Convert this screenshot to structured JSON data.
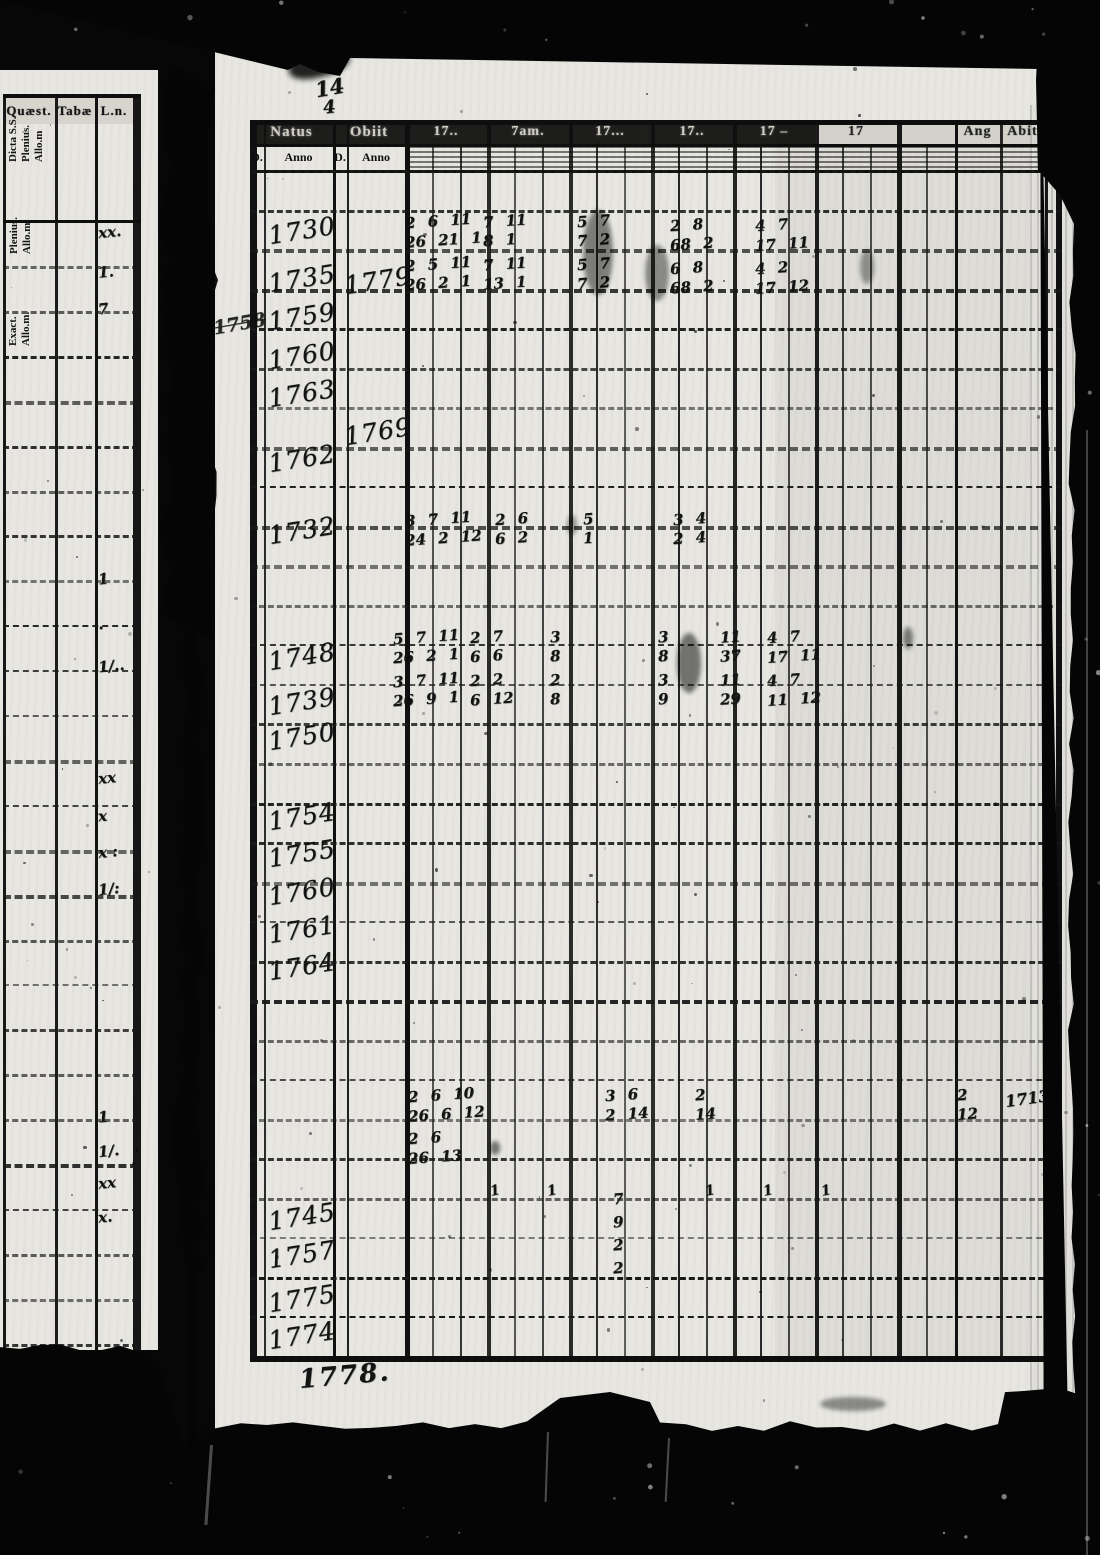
{
  "left_page": {
    "columns": [
      {
        "header": "Quæst.",
        "subheader_lines": [
          "Dicta S.S.",
          "Plenius.",
          "Allo.m"
        ]
      },
      {
        "header": "Tabæ",
        "subheader_lines": [
          "Plenius.",
          "Allo.m."
        ]
      },
      {
        "header": "L.n.",
        "subheader_lines": [
          "Exact.",
          "Allo.m."
        ]
      }
    ],
    "marks": [
      {
        "y": 233,
        "text": "xx."
      },
      {
        "y": 273,
        "text": "1."
      },
      {
        "y": 310,
        "text": "7"
      },
      {
        "y": 580,
        "text": "1"
      },
      {
        "y": 625,
        "text": "."
      },
      {
        "y": 667,
        "text": "1/.."
      },
      {
        "y": 779,
        "text": "xx"
      },
      {
        "y": 817,
        "text": "x"
      },
      {
        "y": 853,
        "text": "x :"
      },
      {
        "y": 890,
        "text": "1/:"
      },
      {
        "y": 1118,
        "text": "1"
      },
      {
        "y": 1152,
        "text": "1/."
      },
      {
        "y": 1184,
        "text": "xx"
      },
      {
        "y": 1218,
        "text": "x."
      }
    ]
  },
  "main_page": {
    "top_annotation": {
      "line1": "14",
      "line2": "4"
    },
    "margin_note": "1758",
    "footer_note": "1778.",
    "side_note": "1713",
    "table": {
      "group_headers": [
        "Natus",
        "Obiit",
        "17..",
        "7am.",
        "17...",
        "17..",
        "17 –",
        "17",
        "",
        "Ang",
        "Abit",
        ""
      ],
      "sub_headers": [
        "D.",
        "Anno",
        "D.",
        "Anno"
      ],
      "years_natus": [
        {
          "text": "1730",
          "y": 187
        },
        {
          "text": "1735",
          "y": 235
        },
        {
          "text": "1759",
          "y": 273
        },
        {
          "text": "1760",
          "y": 312
        },
        {
          "text": "1763",
          "y": 350
        },
        {
          "text": "1762",
          "y": 415
        },
        {
          "text": "1732",
          "y": 487
        },
        {
          "text": "1748",
          "y": 613
        },
        {
          "text": "1739",
          "y": 658
        },
        {
          "text": "1750",
          "y": 693
        },
        {
          "text": "1754",
          "y": 773
        },
        {
          "text": "1755",
          "y": 810
        },
        {
          "text": "1760",
          "y": 848
        },
        {
          "text": "1761",
          "y": 886
        },
        {
          "text": "1764",
          "y": 923
        },
        {
          "text": "1745",
          "y": 1173
        },
        {
          "text": "1757",
          "y": 1211
        },
        {
          "text": "1775",
          "y": 1255
        },
        {
          "text": "1774",
          "y": 1292
        }
      ],
      "years_obiit": [
        {
          "text": "1779",
          "y": 237
        },
        {
          "text": "1769",
          "y": 388
        }
      ],
      "figures": [
        {
          "x": 190,
          "y": 167,
          "lines": [
            "2 6 11",
            "26 21 1",
            "2 5 11",
            "26 2 1"
          ]
        },
        {
          "x": 268,
          "y": 167,
          "lines": [
            "7 11",
            "8 1",
            "7 11",
            "13 1"
          ]
        },
        {
          "x": 362,
          "y": 167,
          "lines": [
            "5 7",
            "7 2",
            "5 7",
            "7 2"
          ]
        },
        {
          "x": 455,
          "y": 171,
          "lines": [
            "2 8",
            "68 2",
            "6 8",
            "68 2"
          ]
        },
        {
          "x": 540,
          "y": 171,
          "lines": [
            "4 7",
            "17 11",
            "4 2",
            "17 12"
          ]
        },
        {
          "x": 190,
          "y": 465,
          "lines": [
            "3 7 11",
            "24 2 12"
          ]
        },
        {
          "x": 280,
          "y": 465,
          "lines": [
            "2 6",
            "6 2"
          ]
        },
        {
          "x": 368,
          "y": 465,
          "lines": [
            "5",
            "1"
          ]
        },
        {
          "x": 458,
          "y": 465,
          "lines": [
            "3 4",
            "2 4"
          ]
        },
        {
          "x": 178,
          "y": 583,
          "lines": [
            "5 7 11",
            "26 2 1",
            "3 7 11",
            "26 9 1"
          ]
        },
        {
          "x": 255,
          "y": 583,
          "lines": [
            "2 7",
            "6 6",
            "2 2",
            "6 12"
          ]
        },
        {
          "x": 335,
          "y": 583,
          "lines": [
            "3",
            "8",
            "2",
            "8"
          ]
        },
        {
          "x": 443,
          "y": 583,
          "lines": [
            "3",
            "8",
            "3",
            "9"
          ]
        },
        {
          "x": 505,
          "y": 583,
          "lines": [
            "11",
            "37",
            "11",
            "29"
          ]
        },
        {
          "x": 552,
          "y": 583,
          "lines": [
            "4 7",
            "17 11",
            "4 7",
            "11 12"
          ]
        },
        {
          "x": 193,
          "y": 1041,
          "lines": [
            "2 6 10",
            "26 6 12",
            "2 6",
            "26 13"
          ]
        },
        {
          "x": 390,
          "y": 1041,
          "lines": [
            "3 6",
            "2 14"
          ]
        },
        {
          "x": 480,
          "y": 1041,
          "lines": [
            "2",
            "14"
          ]
        },
        {
          "x": 742,
          "y": 1041,
          "lines": [
            "2",
            "12"
          ]
        }
      ],
      "column_digits": {
        "x": 398,
        "y": 1145,
        "digits": [
          "7",
          "9",
          "2",
          "2"
        ]
      },
      "tick_row": {
        "y": 1146,
        "xs": [
          275,
          332,
          490,
          548,
          606
        ],
        "text": "1"
      }
    }
  }
}
